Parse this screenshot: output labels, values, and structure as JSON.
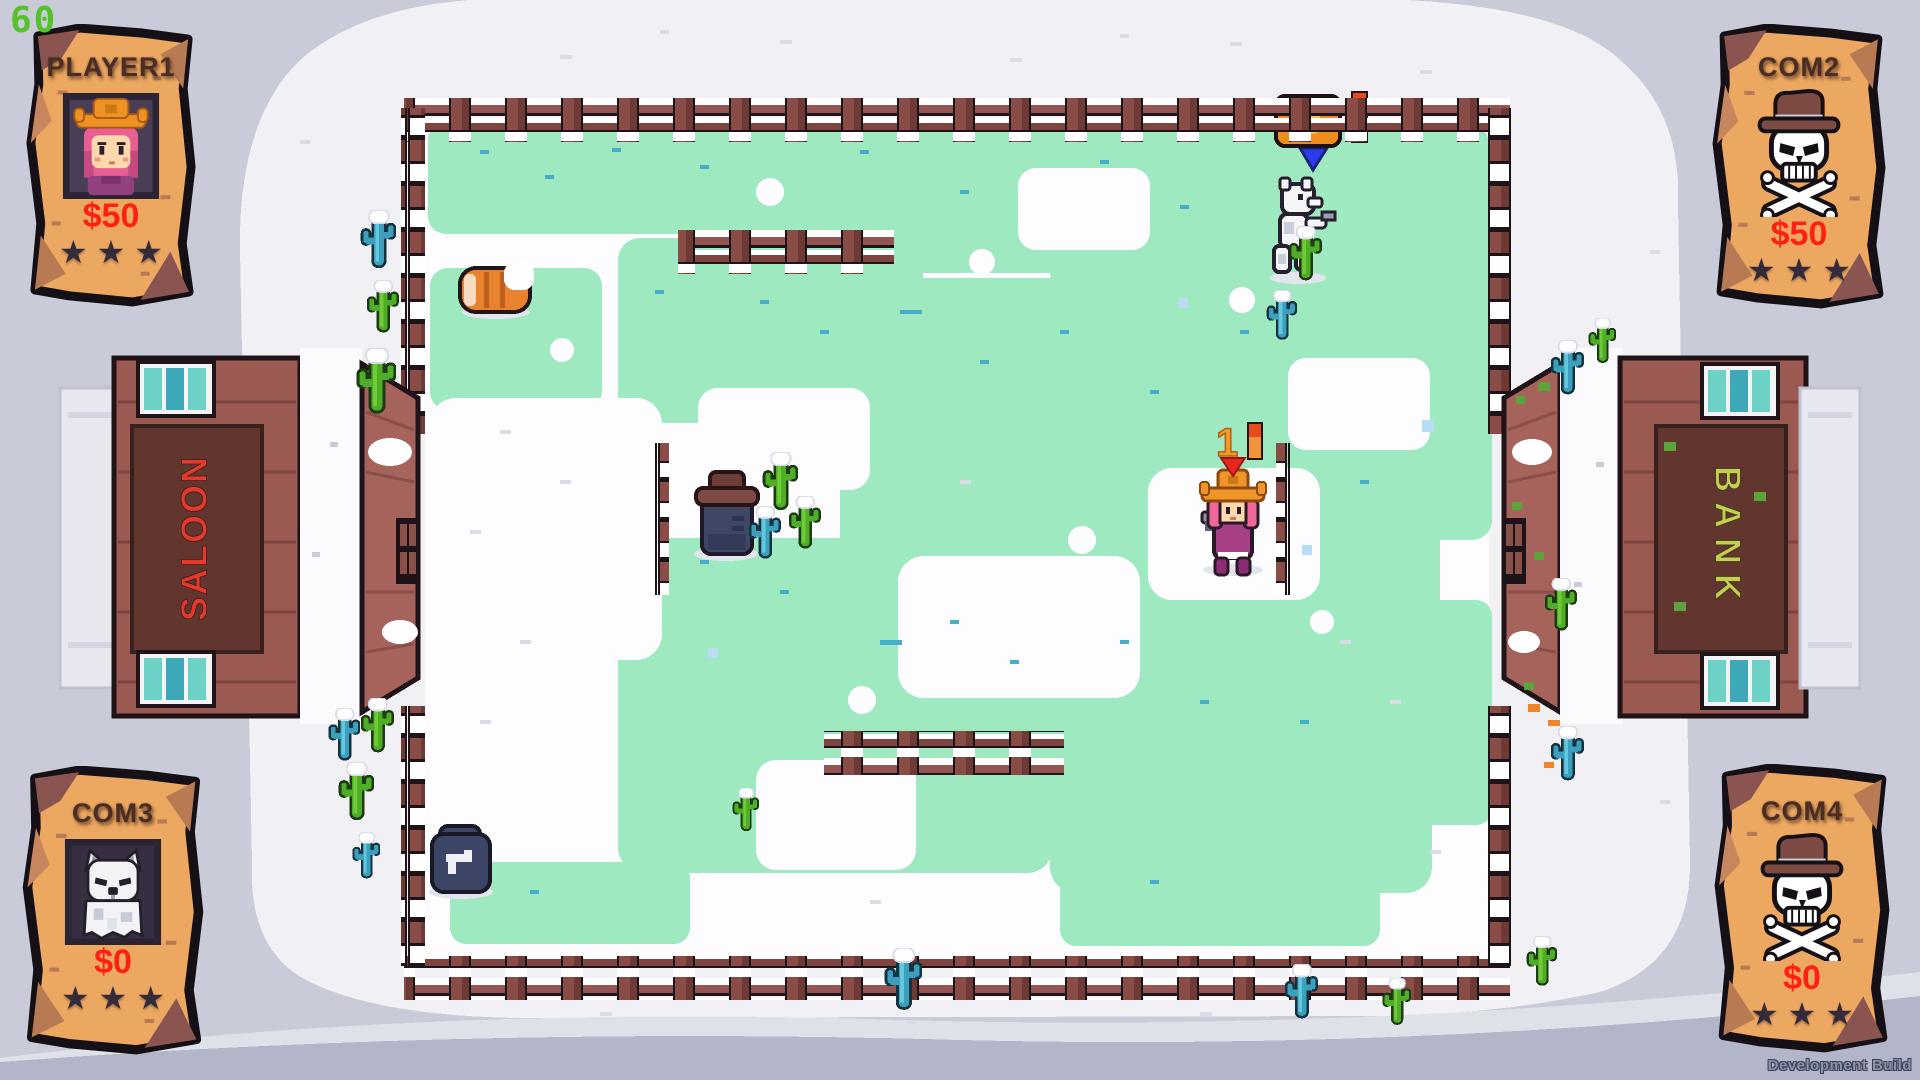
{
  "hud": {
    "fps": "60",
    "build_label": "Development Build"
  },
  "posters": [
    {
      "id": "player1",
      "title": "PLAYER1",
      "portrait": "cowgirl",
      "money": "$50",
      "stars": 3,
      "stars_display": "★★★",
      "position": "top-left",
      "status": "alive"
    },
    {
      "id": "com2",
      "title": "COM2",
      "portrait": "skull-crossbones",
      "money": "$50",
      "stars": 3,
      "stars_display": "★★★",
      "position": "top-right",
      "status": "eliminated"
    },
    {
      "id": "com3",
      "title": "COM3",
      "portrait": "white-wolf",
      "money": "$0",
      "stars": 3,
      "stars_display": "★★★",
      "position": "bottom-left",
      "status": "alive"
    },
    {
      "id": "com4",
      "title": "COM4",
      "portrait": "skull-crossbones",
      "money": "$0",
      "stars": 3,
      "stars_display": "★★★",
      "position": "bottom-right",
      "status": "eliminated"
    }
  ],
  "buildings": {
    "saloon_sign": "SALOON",
    "bank_sign": "BANK"
  },
  "arena": {
    "pickup_count": "1"
  },
  "icons": {
    "star-icon": "★",
    "skull-crossbones-icon": "☠",
    "revolver-icon": "pistol-on-crate",
    "player-arrow-icon": "red-triangle-down",
    "com-arrow-icon": "blue-triangle-down",
    "dynamite-meter-icon": "red-orange-bar",
    "powerup-crate-icon": "orange-box"
  },
  "colors": {
    "fps_green": "#54c22a",
    "money_red": "#ff2015",
    "saloon_sign_red": "#e43a2c",
    "bank_sign_yellow": "#c6ce52",
    "parchment": "#eca761",
    "mint_grass": "#9fe9c1",
    "snow": "#f1f1f5",
    "outer_ground": "#c9cbd8",
    "fence_wood": "#8a4c47"
  }
}
